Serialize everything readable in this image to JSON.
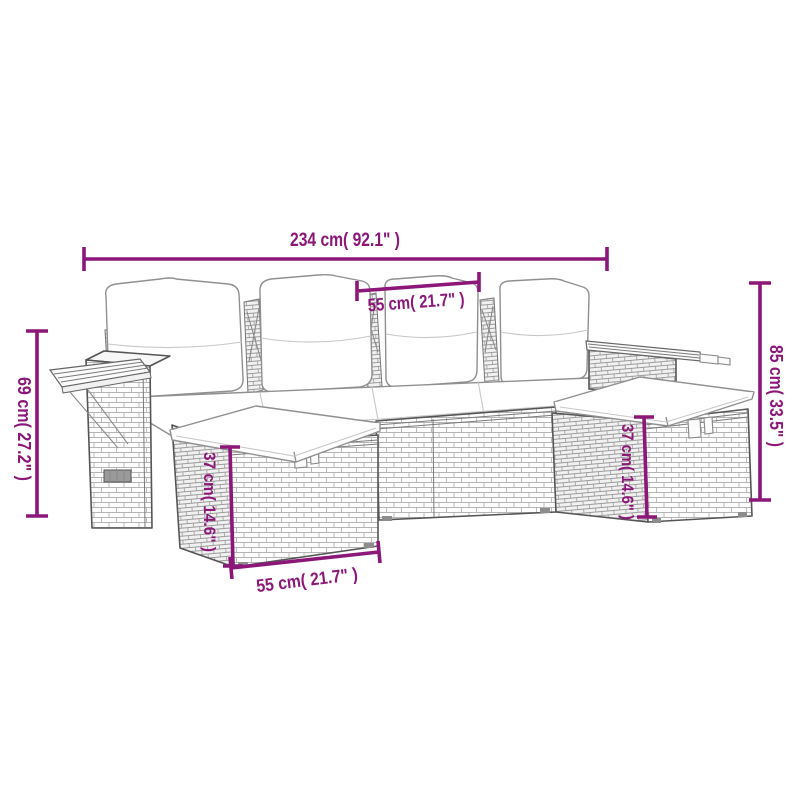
{
  "diagram": {
    "title": "garden-sofa-set-dimension-diagram",
    "colors": {
      "background": "#ffffff",
      "dimension": "#8C1779",
      "line_art": "#555555",
      "wicker_light": "#b5b5b5",
      "wicker_dark": "#9b9b9b"
    },
    "dims": {
      "total_width": "234 cm( 92.1\" )",
      "seat_width": "55 cm( 21.7\" )",
      "tray_height": "69 cm( 27.2\" )",
      "back_height": "85 cm( 33.5\" )",
      "ottoman_width": "55 cm( 21.7\" )",
      "ottoman_height_left": "37 cm( 14.6\" )",
      "ottoman_height_right": "37 cm( 14.6\" )"
    }
  }
}
